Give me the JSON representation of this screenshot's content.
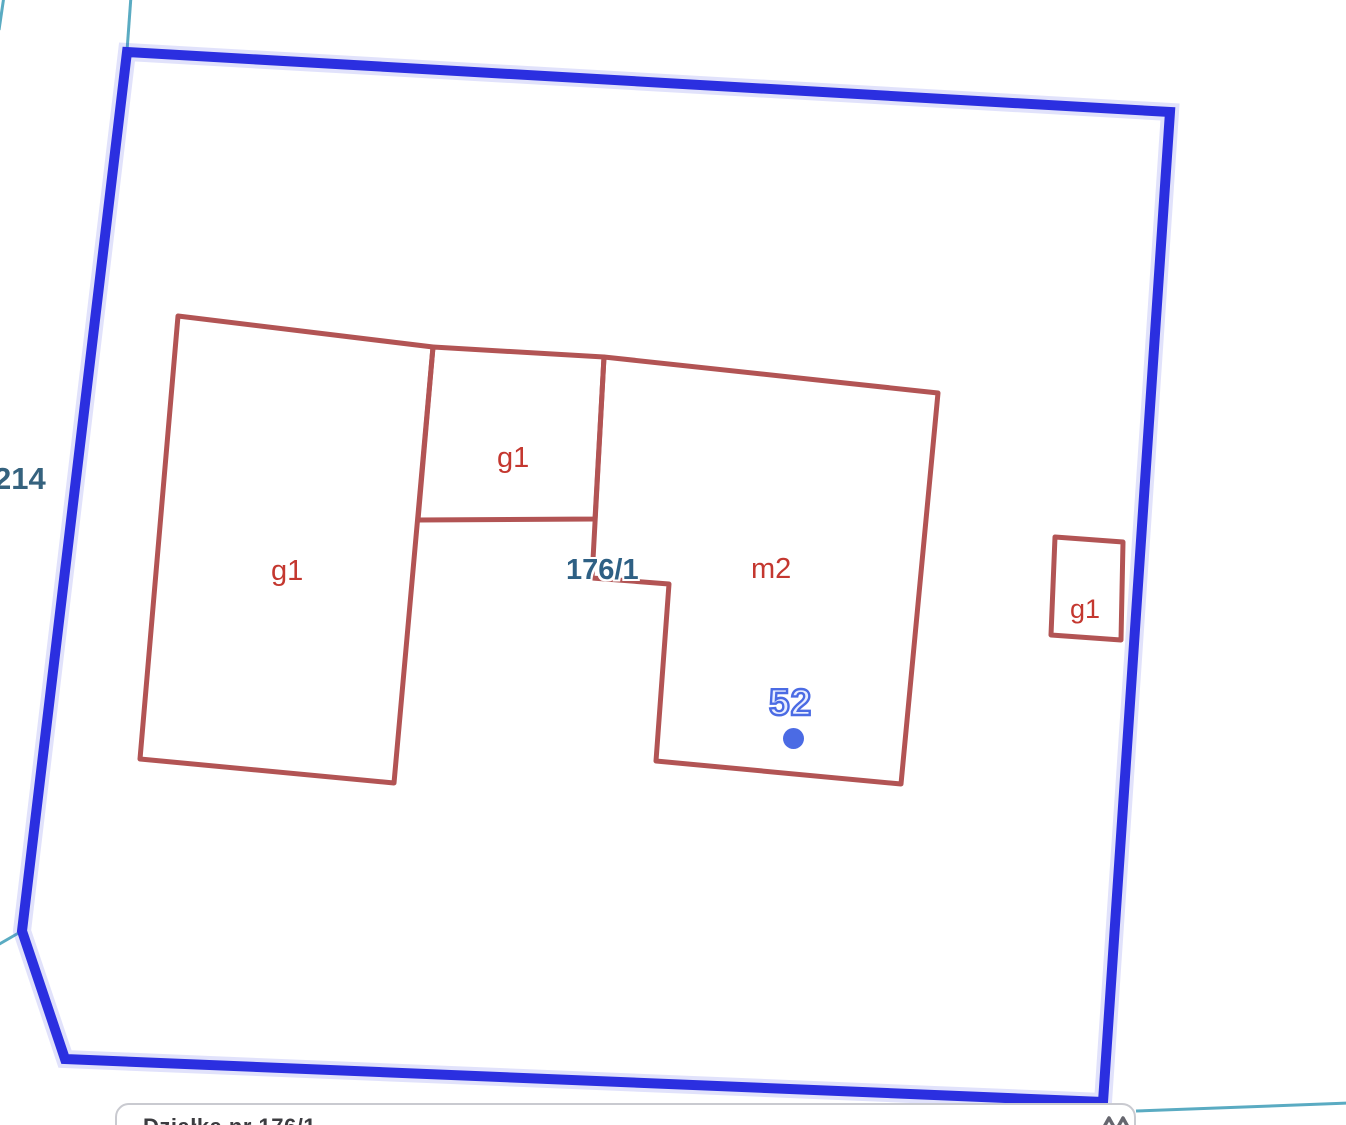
{
  "map": {
    "parcel": {
      "number": "176/1",
      "boundary_color": "#2b2fe0"
    },
    "adjacent_parcel_number": "214",
    "address_point": {
      "number": "52",
      "color": "#4b6be4"
    },
    "buildings": [
      {
        "id": "building-left",
        "label": "g1"
      },
      {
        "id": "building-small-square",
        "label": "g1"
      },
      {
        "id": "building-main",
        "label": "m2"
      },
      {
        "id": "building-right",
        "label": "g1"
      }
    ],
    "colors": {
      "building_outline": "#b25454",
      "building_label": "#c4372f",
      "parcel_label": "#2e6084",
      "neighbor_boundary_line": "#5aabc2"
    }
  },
  "bottom_bar": {
    "text_partial": "Działka nr 176/1",
    "icon": "double-peak-icon"
  }
}
